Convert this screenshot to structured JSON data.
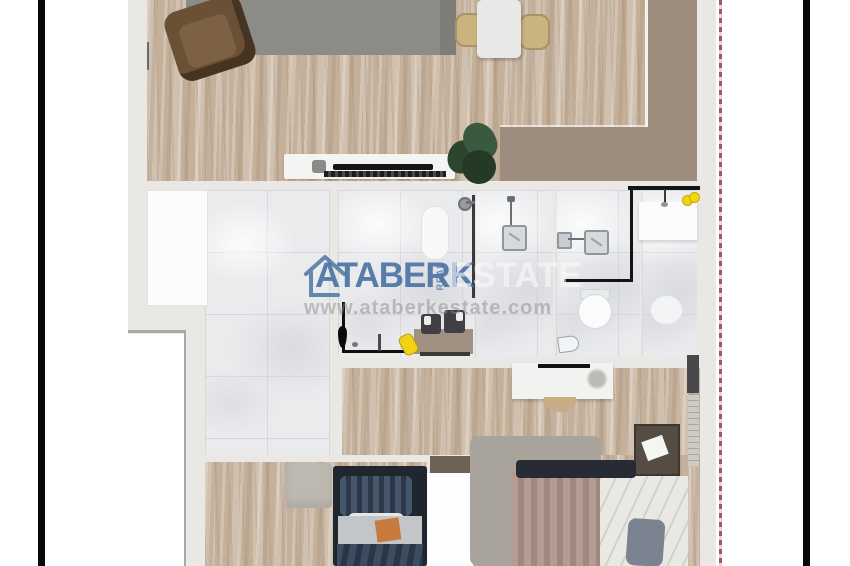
{
  "watermark": {
    "brand_left": "ATABERK",
    "brand_small_vertical": "REAL",
    "brand_right": "ESTATE",
    "website": "www.ataberkestate.com",
    "logo_icon": "house-outline-icon"
  },
  "colors": {
    "accent": "#8c2f45",
    "brand": "#4d76a6",
    "wall": "#e9e8e5",
    "wood": "#c8b6a3",
    "tile": "#eaebed",
    "terrace": "#9c8d7f",
    "rug": "#8c8c87",
    "frame_line": "#070707"
  },
  "floor_plan": {
    "style": "top-down 3D rendered apartment plan, cropped top and bottom",
    "rooms": [
      {
        "name": "living-room",
        "floor": "wood",
        "furniture": [
          "area-rug",
          "armchair",
          "dining-table",
          "dining-chair-left",
          "dining-chair-right",
          "tv-console",
          "tv",
          "potted-plant"
        ]
      },
      {
        "name": "terrace",
        "floor": "terrace"
      },
      {
        "name": "entry-hall",
        "floor": "marble-tile"
      },
      {
        "name": "light-well",
        "floor": "white"
      },
      {
        "name": "bathroom-1",
        "floor": "tile",
        "furniture": [
          "washbasin",
          "shower-head",
          "glass-screen",
          "vanity-counter",
          "twin-dark-sinks",
          "yellow-stool",
          "floor-faucet"
        ]
      },
      {
        "name": "shower-room",
        "floor": "tile",
        "furniture": [
          "square-shower-head",
          "shower-valve",
          "glass-screen"
        ]
      },
      {
        "name": "bathroom-2",
        "floor": "tile",
        "furniture": [
          "square-shower-head",
          "wall-fixture",
          "glass-screen",
          "toilet",
          "bidet"
        ]
      },
      {
        "name": "wc",
        "floor": "tile",
        "furniture": [
          "sink-counter",
          "faucet",
          "yellow-glasses",
          "toilet"
        ]
      },
      {
        "name": "corridor",
        "floor": "wood"
      },
      {
        "name": "bedroom",
        "floor": "wood",
        "furniture": [
          "wardrobe-mat",
          "single-bed",
          "striped-pillow",
          "white-sheet",
          "orange-cushion",
          "striped-blanket"
        ]
      },
      {
        "name": "master-bedroom",
        "floor": "wood",
        "furniture": [
          "dresser",
          "dresser-handle",
          "deco-plant",
          "half-round-stool",
          "area-rug",
          "nightstand",
          "note-card",
          "double-bed",
          "dark-pillows",
          "striped-duvet",
          "white-duvet",
          "gray-pillow",
          "wall-shelf",
          "book-strip"
        ]
      }
    ]
  }
}
